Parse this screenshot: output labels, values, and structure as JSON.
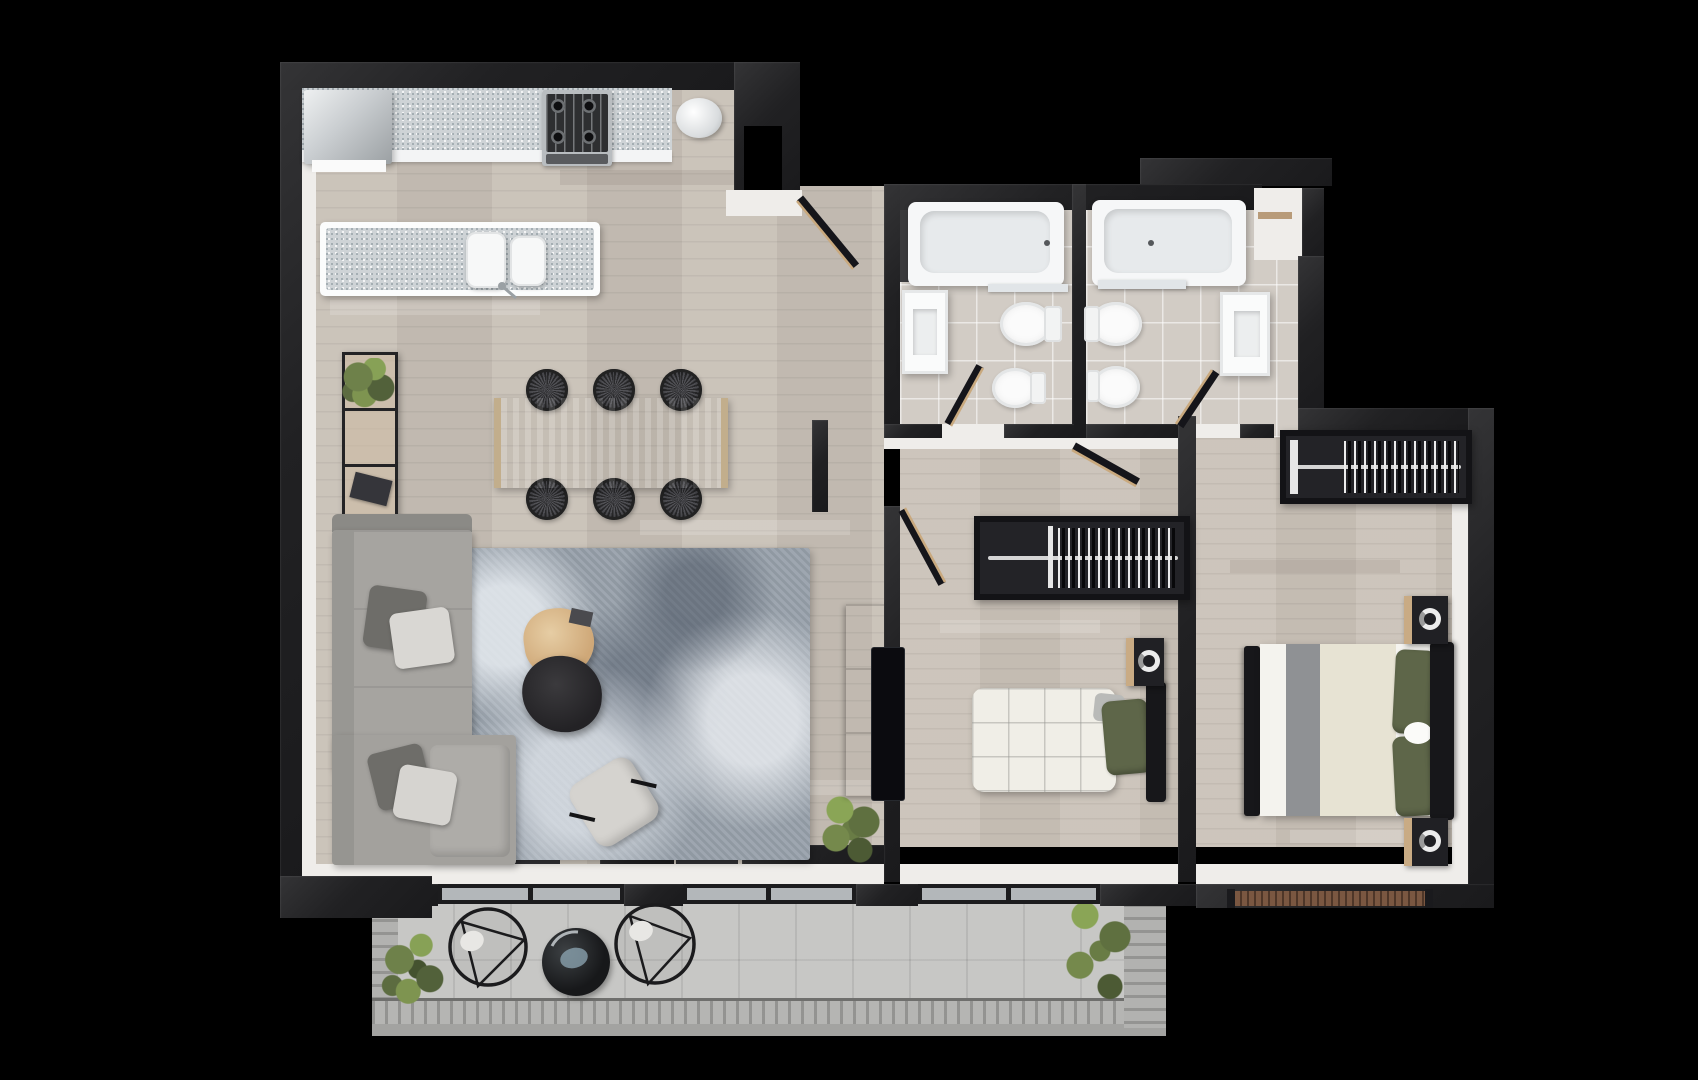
{
  "scene": {
    "type": "3d-floor-plan-render",
    "description": "Top-down 3D rendering of a two-bedroom two-bathroom apartment with open kitchen, dining and living area and a full-width balcony, isolated on a black background",
    "background_color": "#000000",
    "visible_text": ""
  },
  "palette": {
    "wall": "#1e1e20",
    "wall_inner": "#efedea",
    "wood_floor": "#c8c0b6",
    "bath_tile": "#d2ccc5",
    "balcony_tile": "#c7c7c5",
    "counter_speckle": "#ced3d6",
    "island_white": "#fbfcfc",
    "table_wood": "#dbcfb9",
    "sofa_gray": "#a6a4a0",
    "rug_blue_gray": "#98a1ab",
    "furniture_dark": "#17171a",
    "duvet_cream": "#e7e3d3",
    "blanket_gray": "#8f9194",
    "pillow_olive": "#5e6649",
    "plant_green": "#6e814a",
    "window_wood": "#7a5741",
    "fixture_white": "#f7f8f8"
  },
  "rooms": [
    {
      "name": "kitchen-dining-living",
      "floor": "light wood planks",
      "furniture": [
        "refrigerator",
        "kitchen counter",
        "gas stove with 4 burners",
        "range hood",
        "island counter with double sink",
        "metal shelf rack with plant and book",
        "dining table",
        "6 woven dining chairs",
        "L-shaped gray sofa",
        "4 throw pillows",
        "distressed blue-gray area rug",
        "tan trefoil coffee table",
        "black trefoil coffee table",
        "gray lounge chair",
        "potted plant",
        "wooden TV sideboard",
        "wall-mounted TV"
      ]
    },
    {
      "name": "entry",
      "furniture": [
        "entry door leaf",
        "threshold"
      ]
    },
    {
      "name": "bathroom-1",
      "floor": "beige tile",
      "furniture": [
        "bathtub",
        "vanity sink",
        "toilet",
        "bidet",
        "door leaf"
      ]
    },
    {
      "name": "bathroom-2",
      "floor": "beige tile",
      "furniture": [
        "bathtub",
        "toilet",
        "bidet",
        "vanity sink",
        "wall niche",
        "door leaf"
      ]
    },
    {
      "name": "bedroom-2",
      "floor": "light wood planks",
      "furniture": [
        "wardrobe with hangers",
        "single bed with quilted duvet",
        "olive pillow",
        "gray pillow",
        "nightstand with lamp",
        "door leaf"
      ]
    },
    {
      "name": "master-bedroom",
      "floor": "light wood planks",
      "furniture": [
        "wardrobe with hangers",
        "double bed with gray runner",
        "2 olive pillows",
        "2 nightstands with lamps",
        "window with wooden blinds"
      ]
    },
    {
      "name": "balcony",
      "floor": "gray tile",
      "furniture": [
        "2 wire frame lounge chairs",
        "round dark side table",
        "2 potted plants",
        "concrete parapet railing"
      ]
    }
  ]
}
